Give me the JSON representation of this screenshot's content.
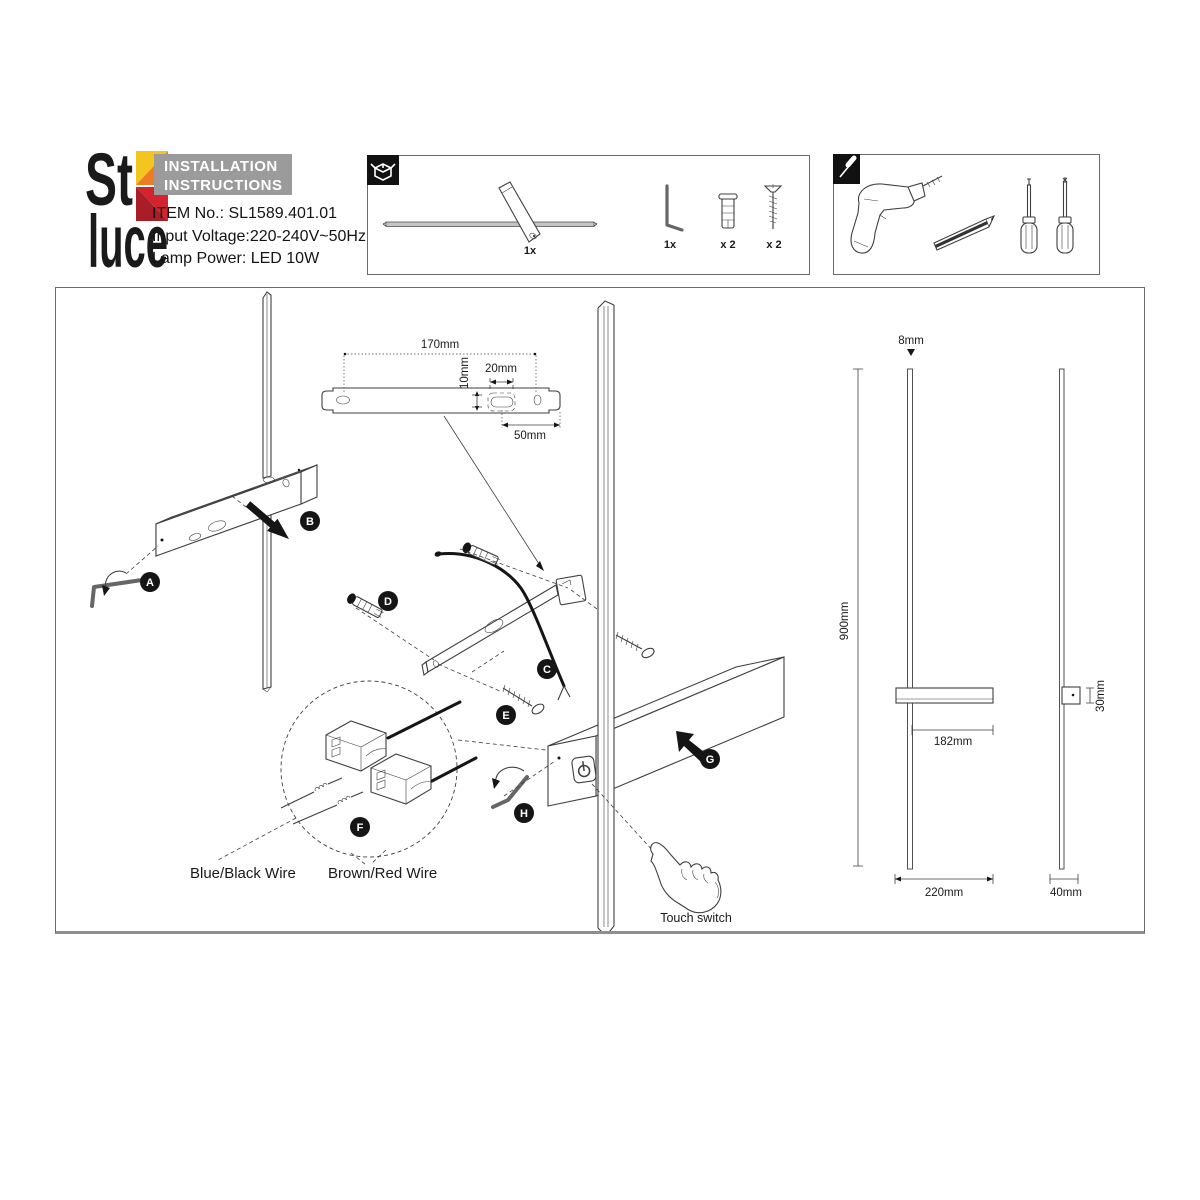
{
  "brand": {
    "name_top": "St",
    "name_bottom": "luce",
    "colors": {
      "yellow": "#f3c51f",
      "orange": "#ee7c24",
      "red": "#d2232e",
      "dark_red": "#a91e26"
    }
  },
  "header": {
    "title_line1": "INSTALLATION",
    "title_line2": "INSTRUCTIONS",
    "item_no": "ITEM No.: SL1589.401.01",
    "input_voltage": "Input Voltage:220-240V~50Hz",
    "lamp_power": "Lamp Power: LED 10W"
  },
  "package_box": {
    "lamp_qty": "1x",
    "hex_key_qty": "1x",
    "anchor_qty": "x 2",
    "screw_qty": "x 2"
  },
  "diagram": {
    "steps": [
      "A",
      "B",
      "C",
      "D",
      "E",
      "F",
      "G",
      "H"
    ],
    "dims": {
      "bracket_length": "170mm",
      "hole_offset": "10mm",
      "hole_width": "20mm",
      "hole_to_end": "50mm",
      "rod_diameter": "8mm",
      "total_height": "900mm",
      "arm_length": "182mm",
      "base_height": "30mm",
      "front_width": "220mm",
      "side_width": "40mm"
    },
    "labels": {
      "wire_blue_black": "Blue/Black Wire",
      "wire_brown_red": "Brown/Red Wire",
      "touch_switch": "Touch switch"
    }
  }
}
